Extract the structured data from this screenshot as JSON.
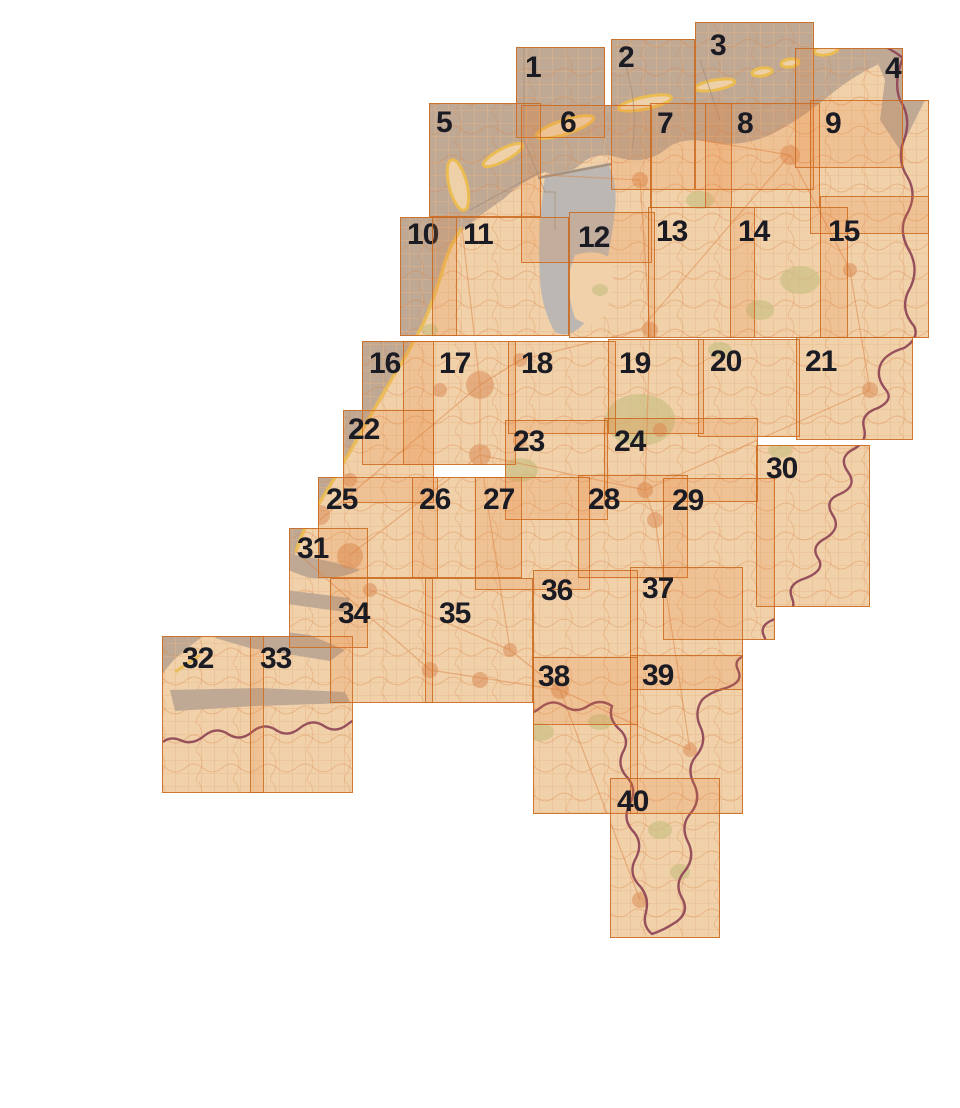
{
  "map": {
    "colors": {
      "page_background": "#ffffff",
      "sea": "#b7b2aa",
      "land": "#f3e2c3",
      "lake": "#b4c3cd",
      "island_yellow": "#ecc95a",
      "island_fill": "#f0e3c2",
      "green_area": "#c3cd94",
      "road_orange": "#d9864a",
      "city_blob": "#d89263",
      "fine_grid": "#e6c29b",
      "national_border_purple": "#7d3a5e",
      "province_line_grey": "#9a948c",
      "sheet_fill_rgba": "rgba(233,124,46,0.17)",
      "sheet_border": "rgba(201,106,32,0.88)",
      "label_color": "#1b1b24"
    },
    "legend": "Numbered map sheet index grid over the Netherlands",
    "sheet_count": 40
  },
  "sheets": [
    {
      "number": "1",
      "x": 516,
      "y": 47,
      "w": 89,
      "h": 91,
      "lx": 524,
      "ly": 52
    },
    {
      "number": "2",
      "x": 611,
      "y": 39,
      "w": 84,
      "h": 151,
      "lx": 617,
      "ly": 42
    },
    {
      "number": "3",
      "x": 695,
      "y": 22,
      "w": 119,
      "h": 168,
      "lx": 709,
      "ly": 30
    },
    {
      "number": "4",
      "x": 795,
      "y": 48,
      "w": 108,
      "h": 120,
      "lx": 884,
      "ly": 53
    },
    {
      "number": "5",
      "x": 429,
      "y": 103,
      "w": 112,
      "h": 114,
      "lx": 435,
      "ly": 107
    },
    {
      "number": "6",
      "x": 521,
      "y": 105,
      "w": 131,
      "h": 158,
      "lx": 559,
      "ly": 107
    },
    {
      "number": "7",
      "x": 650,
      "y": 103,
      "w": 82,
      "h": 105,
      "lx": 656,
      "ly": 108
    },
    {
      "number": "8",
      "x": 705,
      "y": 103,
      "w": 115,
      "h": 105,
      "lx": 736,
      "ly": 108
    },
    {
      "number": "9",
      "x": 810,
      "y": 100,
      "w": 119,
      "h": 134,
      "lx": 824,
      "ly": 108
    },
    {
      "number": "10",
      "x": 400,
      "y": 217,
      "w": 57,
      "h": 119,
      "lx": 406,
      "ly": 219
    },
    {
      "number": "11",
      "x": 432,
      "y": 217,
      "w": 137,
      "h": 119,
      "lx": 462,
      "ly": 219
    },
    {
      "number": "12",
      "x": 569,
      "y": 212,
      "w": 86,
      "h": 126,
      "lx": 577,
      "ly": 222
    },
    {
      "number": "13",
      "x": 648,
      "y": 207,
      "w": 107,
      "h": 131,
      "lx": 655,
      "ly": 216
    },
    {
      "number": "14",
      "x": 730,
      "y": 207,
      "w": 118,
      "h": 131,
      "lx": 737,
      "ly": 216
    },
    {
      "number": "15",
      "x": 820,
      "y": 196,
      "w": 109,
      "h": 142,
      "lx": 827,
      "ly": 216
    },
    {
      "number": "16",
      "x": 362,
      "y": 341,
      "w": 72,
      "h": 124,
      "lx": 368,
      "ly": 348
    },
    {
      "number": "17",
      "x": 403,
      "y": 341,
      "w": 113,
      "h": 124,
      "lx": 438,
      "ly": 348
    },
    {
      "number": "18",
      "x": 508,
      "y": 341,
      "w": 108,
      "h": 93,
      "lx": 520,
      "ly": 348
    },
    {
      "number": "19",
      "x": 608,
      "y": 339,
      "w": 96,
      "h": 95,
      "lx": 618,
      "ly": 348
    },
    {
      "number": "20",
      "x": 698,
      "y": 339,
      "w": 102,
      "h": 98,
      "lx": 709,
      "ly": 346
    },
    {
      "number": "21",
      "x": 796,
      "y": 337,
      "w": 117,
      "h": 103,
      "lx": 804,
      "ly": 346
    },
    {
      "number": "22",
      "x": 343,
      "y": 410,
      "w": 91,
      "h": 93,
      "lx": 347,
      "ly": 414
    },
    {
      "number": "23",
      "x": 505,
      "y": 420,
      "w": 103,
      "h": 100,
      "lx": 512,
      "ly": 426
    },
    {
      "number": "24",
      "x": 604,
      "y": 418,
      "w": 154,
      "h": 84,
      "lx": 613,
      "ly": 426
    },
    {
      "number": "25",
      "x": 318,
      "y": 477,
      "w": 120,
      "h": 101,
      "lx": 325,
      "ly": 484
    },
    {
      "number": "26",
      "x": 412,
      "y": 477,
      "w": 110,
      "h": 101,
      "lx": 418,
      "ly": 484
    },
    {
      "number": "27",
      "x": 475,
      "y": 477,
      "w": 115,
      "h": 113,
      "lx": 482,
      "ly": 484
    },
    {
      "number": "28",
      "x": 578,
      "y": 475,
      "w": 110,
      "h": 103,
      "lx": 587,
      "ly": 484
    },
    {
      "number": "29",
      "x": 663,
      "y": 478,
      "w": 112,
      "h": 162,
      "lx": 671,
      "ly": 485
    },
    {
      "number": "30",
      "x": 756,
      "y": 445,
      "w": 114,
      "h": 162,
      "lx": 765,
      "ly": 453
    },
    {
      "number": "31",
      "x": 289,
      "y": 528,
      "w": 79,
      "h": 120,
      "lx": 296,
      "ly": 533
    },
    {
      "number": "32",
      "x": 162,
      "y": 636,
      "w": 102,
      "h": 157,
      "lx": 181,
      "ly": 643
    },
    {
      "number": "33",
      "x": 250,
      "y": 636,
      "w": 103,
      "h": 157,
      "lx": 259,
      "ly": 643
    },
    {
      "number": "34",
      "x": 330,
      "y": 578,
      "w": 103,
      "h": 125,
      "lx": 337,
      "ly": 598
    },
    {
      "number": "35",
      "x": 425,
      "y": 578,
      "w": 108,
      "h": 125,
      "lx": 438,
      "ly": 598
    },
    {
      "number": "36",
      "x": 533,
      "y": 570,
      "w": 105,
      "h": 155,
      "lx": 540,
      "ly": 575
    },
    {
      "number": "37",
      "x": 630,
      "y": 567,
      "w": 113,
      "h": 123,
      "lx": 641,
      "ly": 573
    },
    {
      "number": "38",
      "x": 533,
      "y": 657,
      "w": 105,
      "h": 157,
      "lx": 537,
      "ly": 661
    },
    {
      "number": "39",
      "x": 630,
      "y": 655,
      "w": 113,
      "h": 159,
      "lx": 641,
      "ly": 660
    },
    {
      "number": "40",
      "x": 610,
      "y": 778,
      "w": 110,
      "h": 160,
      "lx": 616,
      "ly": 786
    }
  ]
}
